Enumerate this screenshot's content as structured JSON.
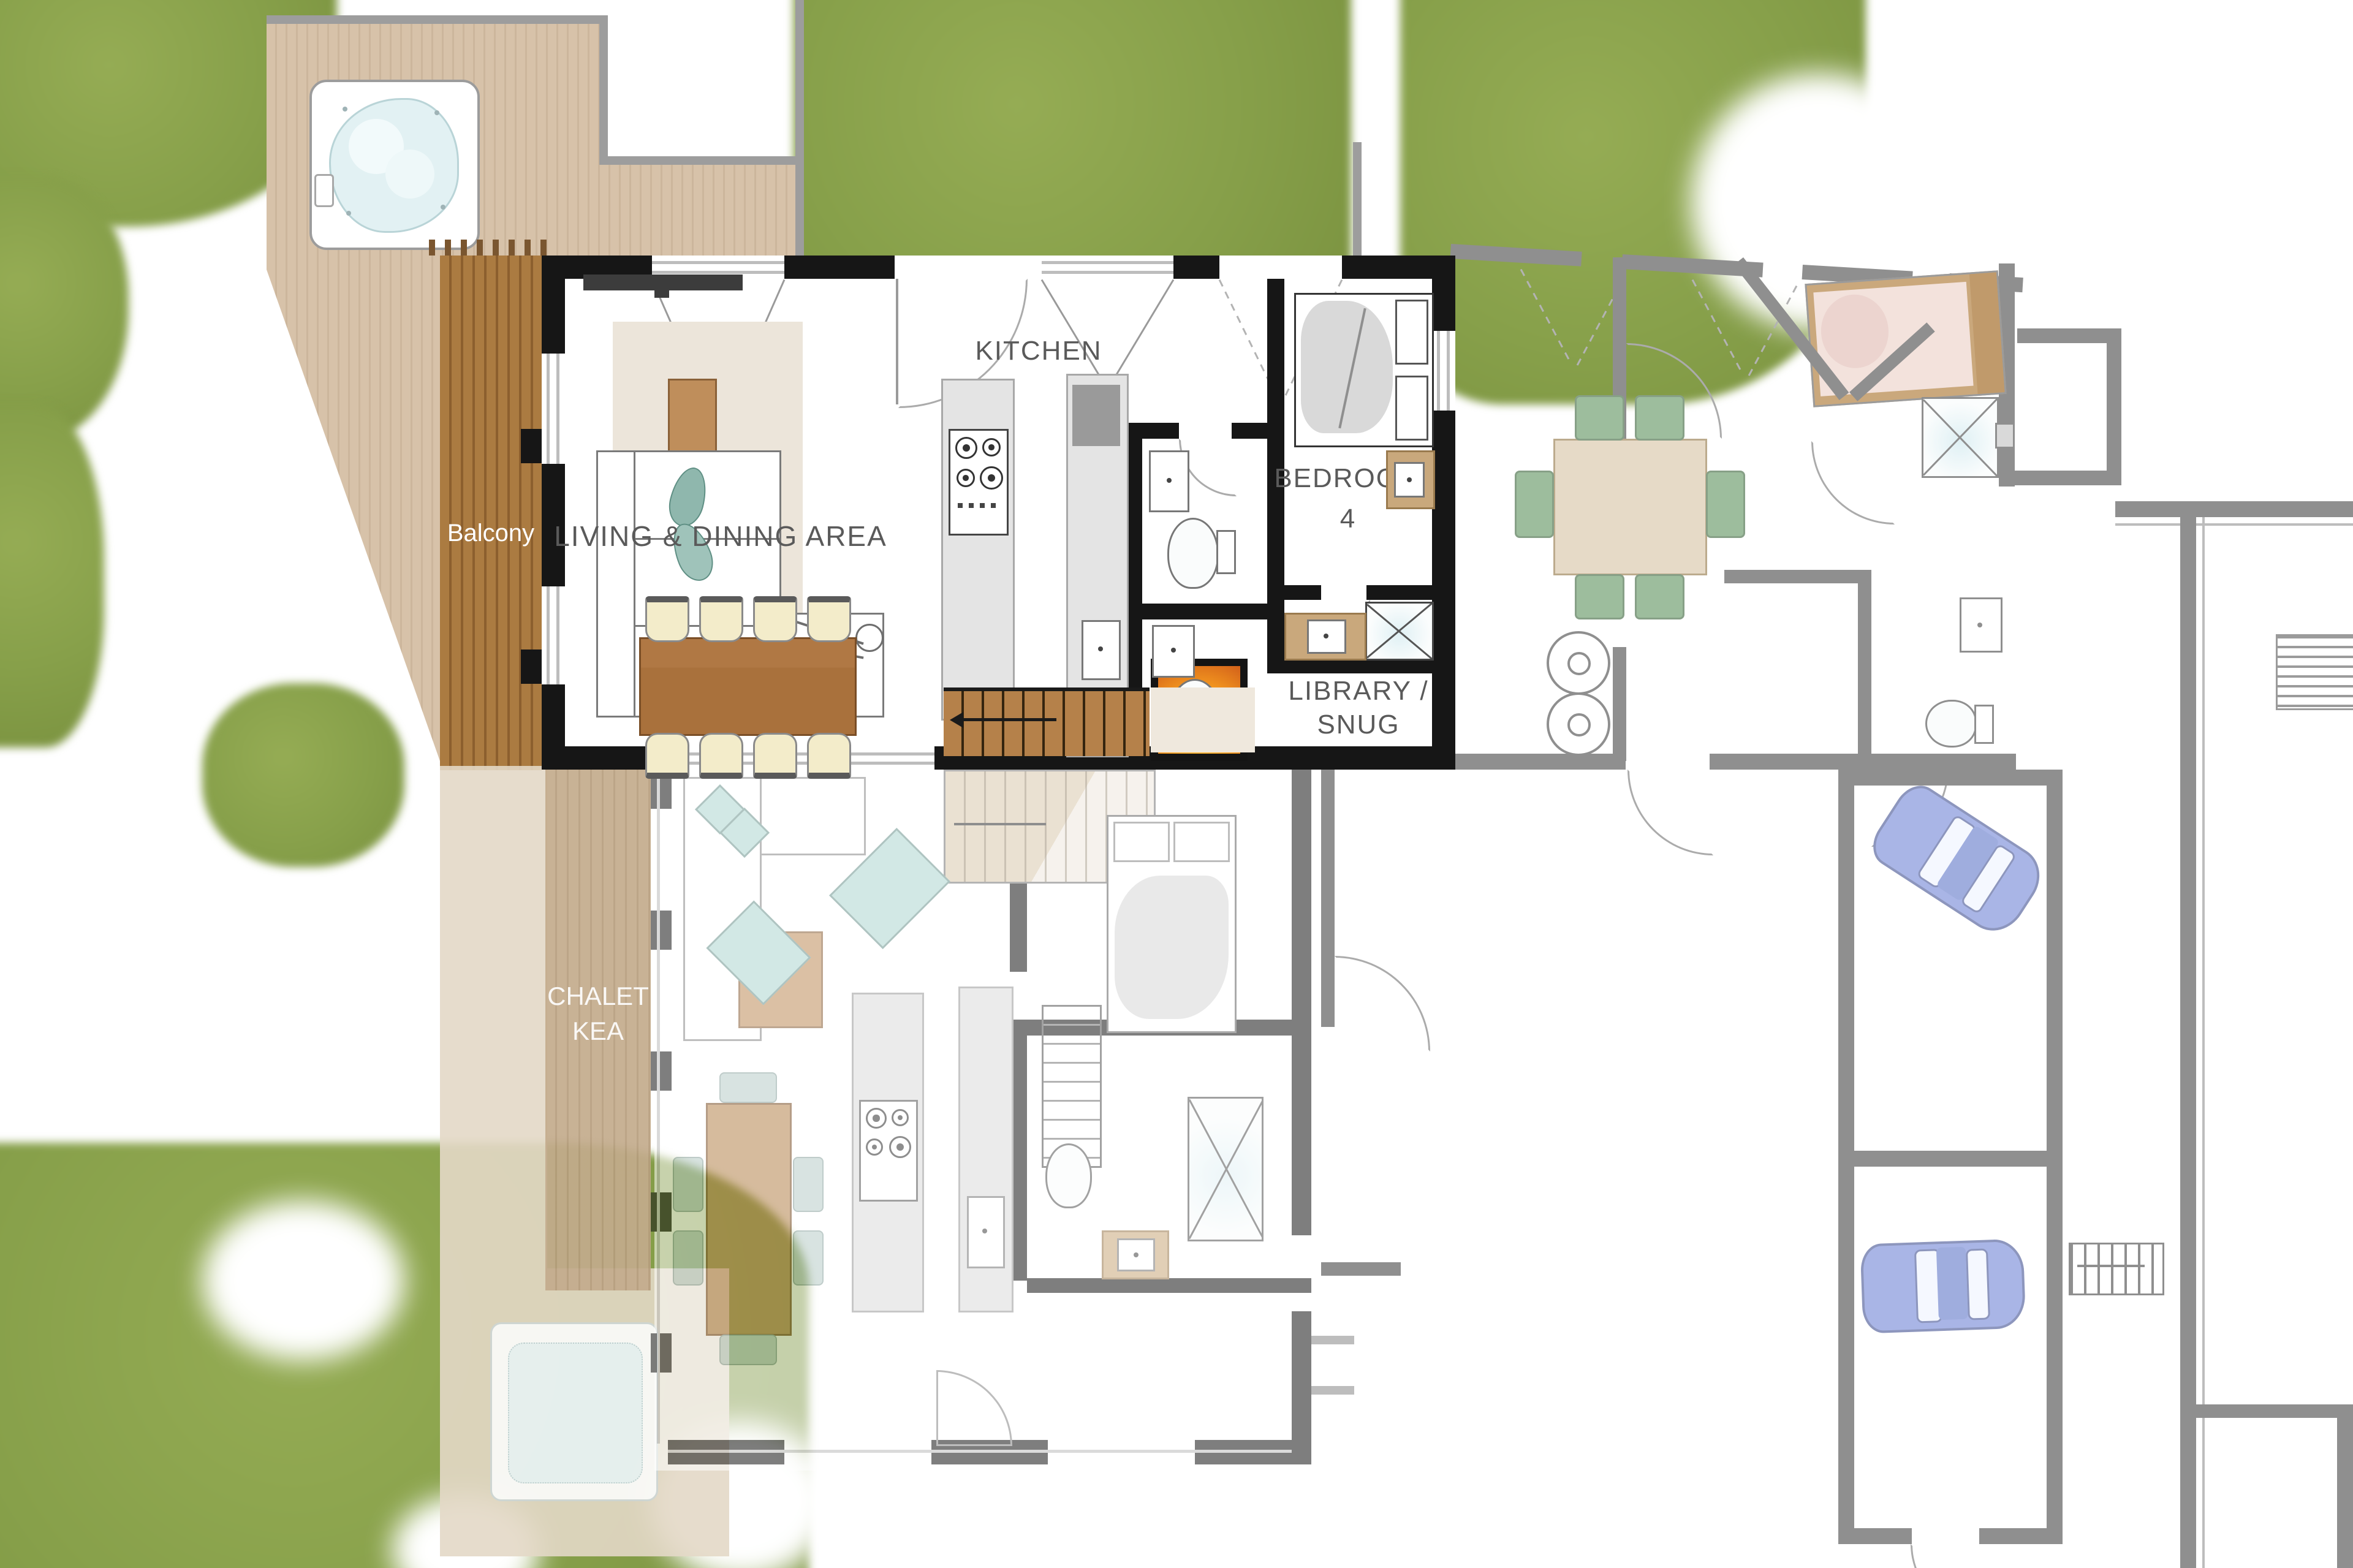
{
  "plan": {
    "labels": {
      "balcony": "Balcony",
      "living_dining": "LIVING & DINING AREA",
      "kitchen": "KITCHEN",
      "bedroom4_line1": "BEDROOM",
      "bedroom4_line2": "4",
      "library_line1": "LIBRARY /",
      "library_line2": "SNUG",
      "chalet_line1": "CHALET",
      "chalet_line2": "KEA"
    },
    "colors": {
      "grass": "#87a04a",
      "deck_wood": "#d7c2a9",
      "balcony_wood": "#ab7b41",
      "lower_balcony_wood": "#c3ab8c",
      "patio": "#e3d8c7",
      "wall_main": "#161616",
      "wall_neighbor": "#8f8f8f",
      "rug": "#ece5da",
      "wood_furniture": "#a9713c",
      "chair_seat": "#f3ecca",
      "green_chair": "#9dbd9d",
      "flame": "#f59a1f",
      "teal_rug": "#aed6d0",
      "car_body": "#a9b5e6",
      "hot_tub_water": "#e2f1f3"
    },
    "features": [
      "hot-tub-icon",
      "fireplace-icon",
      "car-icon",
      "stairs-icon",
      "shower-icon",
      "toilet-icon",
      "sink-icon",
      "bed-icon",
      "sofa-icon",
      "dining-table-icon",
      "washer-icon"
    ]
  }
}
